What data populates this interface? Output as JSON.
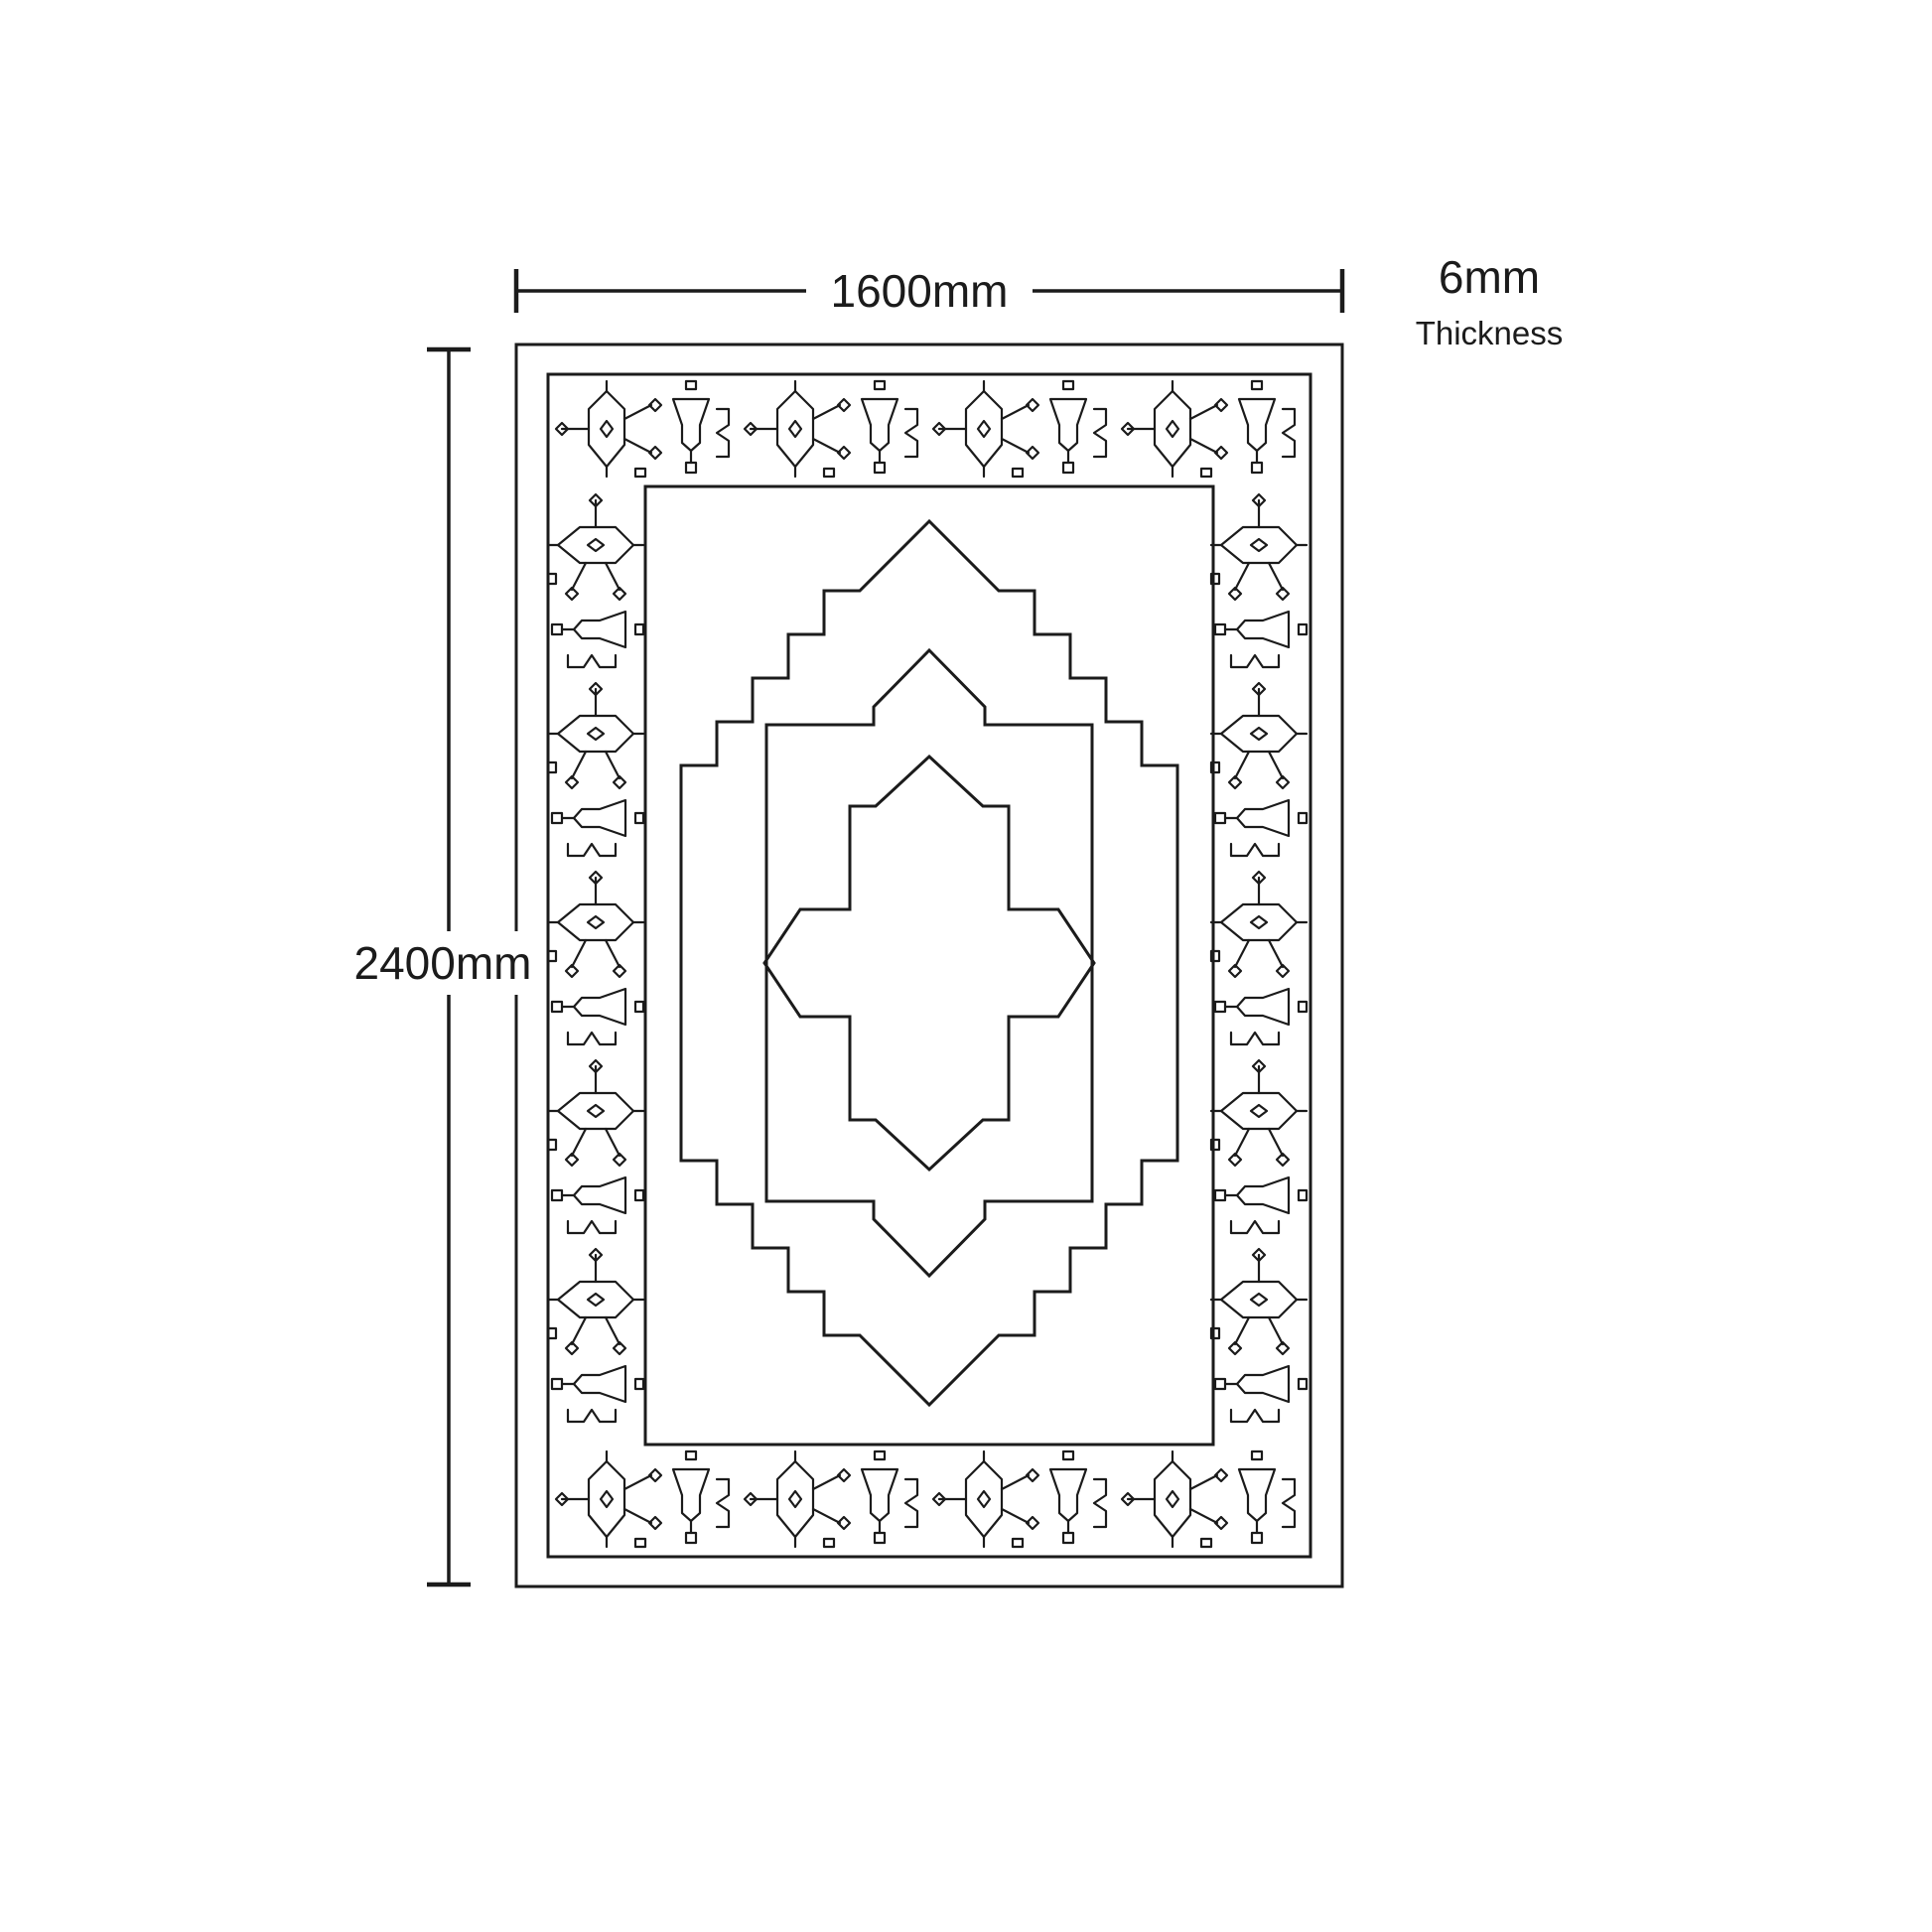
{
  "colors": {
    "background": "#ffffff",
    "line": "#1b1b1b",
    "text": "#1b1b1b"
  },
  "labels": {
    "width": "1600mm",
    "height": "2400mm",
    "thickness_value": "6mm",
    "thickness_caption": "Thickness"
  }
}
